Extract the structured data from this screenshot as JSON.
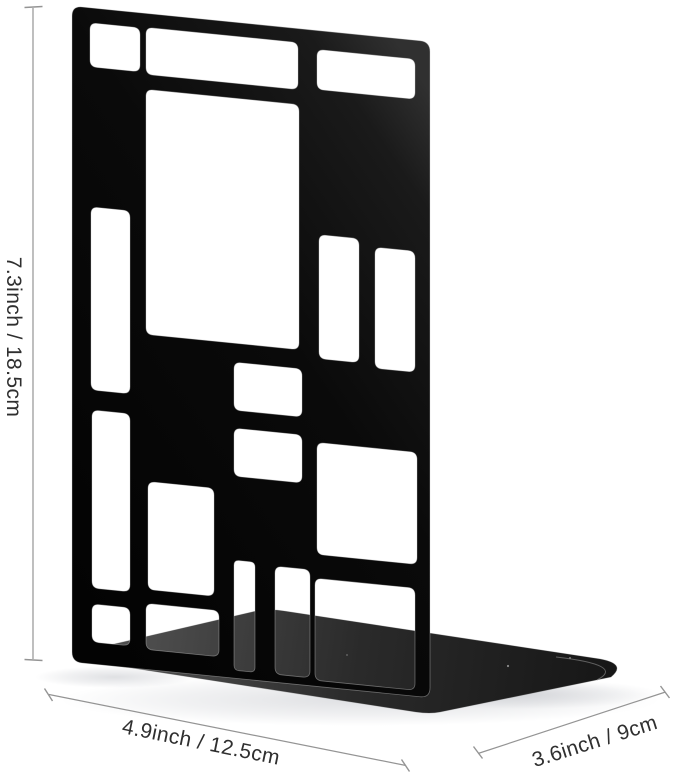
{
  "dimensions": {
    "height_label": "7.3inch / 18.5cm",
    "width_label": "4.9inch / 12.5cm",
    "depth_label": "3.6inch / 9cm"
  },
  "colors": {
    "background": "#ffffff",
    "panel_black": "#030303",
    "panel_mid": "#0a0a0a",
    "panel_sheen": "#303030",
    "base_gray_light": "#4d4d4d",
    "base_gray_mid": "#2a2a2a",
    "base_gray_dark": "#161616",
    "edge_highlight": "#d6d6d6",
    "dimension_line": "#949494",
    "dimension_text": "#2f2f2f"
  }
}
